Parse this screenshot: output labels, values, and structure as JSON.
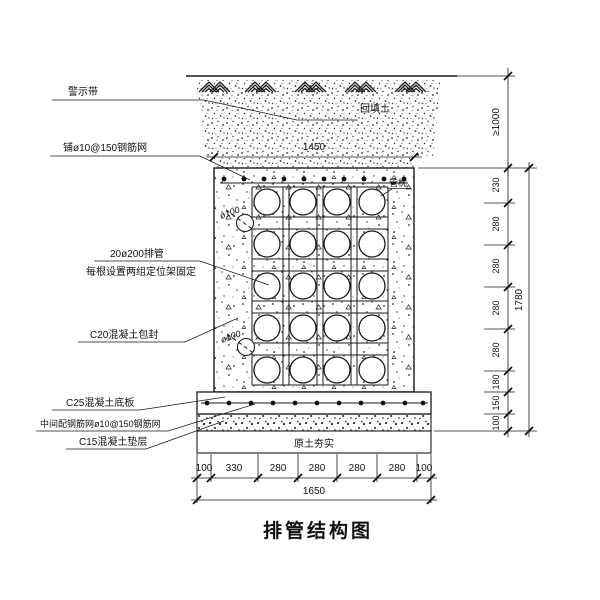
{
  "drawing_title": "排管结构图",
  "callouts": {
    "warning_tape": "警示带",
    "top_rebar_mesh": "铺ø10@150钢筋网",
    "pipe_bank": "20ø200排管",
    "pipe_bank_note": "每根设置两组定位架固定",
    "encapsulation": "C20混凝土包封",
    "base_slab": "C25混凝土底板",
    "middle_rebar_mesh": "中间配钢筋网ø10@150钢筋网",
    "cushion": "C15混凝土垫层",
    "backfill": "回填土",
    "pipe_pillow": "管枕",
    "compacted_soil": "原土夯实",
    "drain_upper": "ø100",
    "drain_lower": "ø100"
  },
  "dimensions": {
    "top_width": "1450",
    "cover_depth": "≥1000",
    "right_total": "1780",
    "right_segments": [
      "230",
      "280",
      "280",
      "280",
      "280",
      "180",
      "150",
      "100"
    ],
    "bottom_total": "1650",
    "bottom_segments": [
      "100",
      "330",
      "280",
      "280",
      "280",
      "280",
      "100"
    ]
  },
  "pipe_grid": {
    "rows": 5,
    "columns": 4
  },
  "colors": {
    "line": "#1a1a1a",
    "background": "#ffffff"
  }
}
